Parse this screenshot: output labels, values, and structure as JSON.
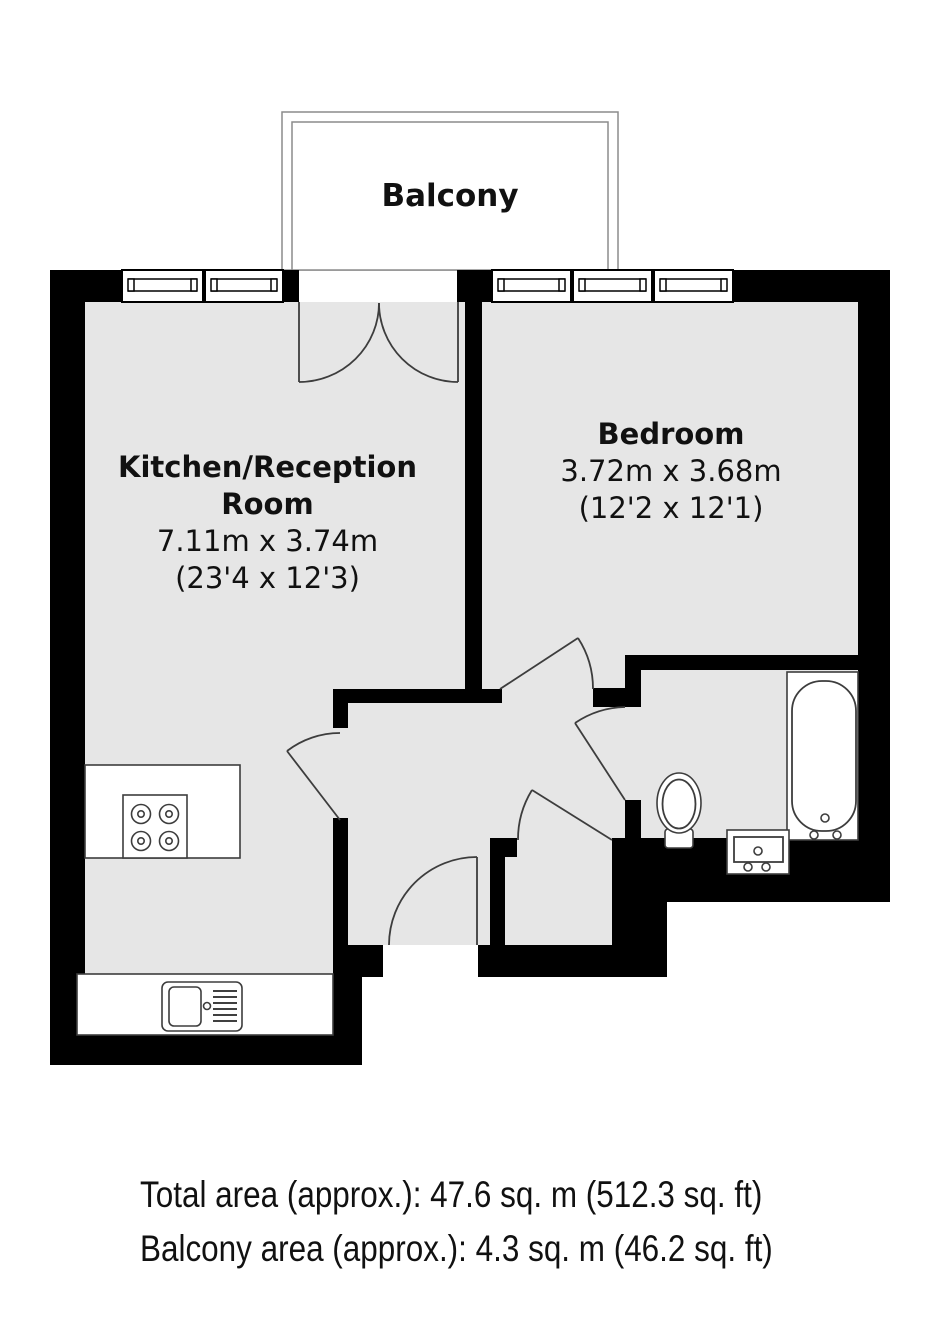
{
  "plan": {
    "balcony": {
      "label": "Balcony"
    },
    "rooms": {
      "kitchen": {
        "name_line1": "Kitchen/Reception",
        "name_line2": "Room",
        "dims_metric": "7.11m x 3.74m",
        "dims_imperial": "(23'4 x 12'3)"
      },
      "bedroom": {
        "name": "Bedroom",
        "dims_metric": "3.72m x 3.68m",
        "dims_imperial": "(12'2 x 12'1)"
      }
    },
    "footer": {
      "total_area": "Total area (approx.): 47.6 sq. m (512.3 sq. ft)",
      "balcony_area": "Balcony area (approx.): 4.3 sq. m (46.2 sq. ft)"
    },
    "colors": {
      "wall": "#000000",
      "floor": "#e6e6e6",
      "line": "#3d3d3d",
      "balcony_line": "#8c8c8c",
      "text": "#111111"
    }
  }
}
